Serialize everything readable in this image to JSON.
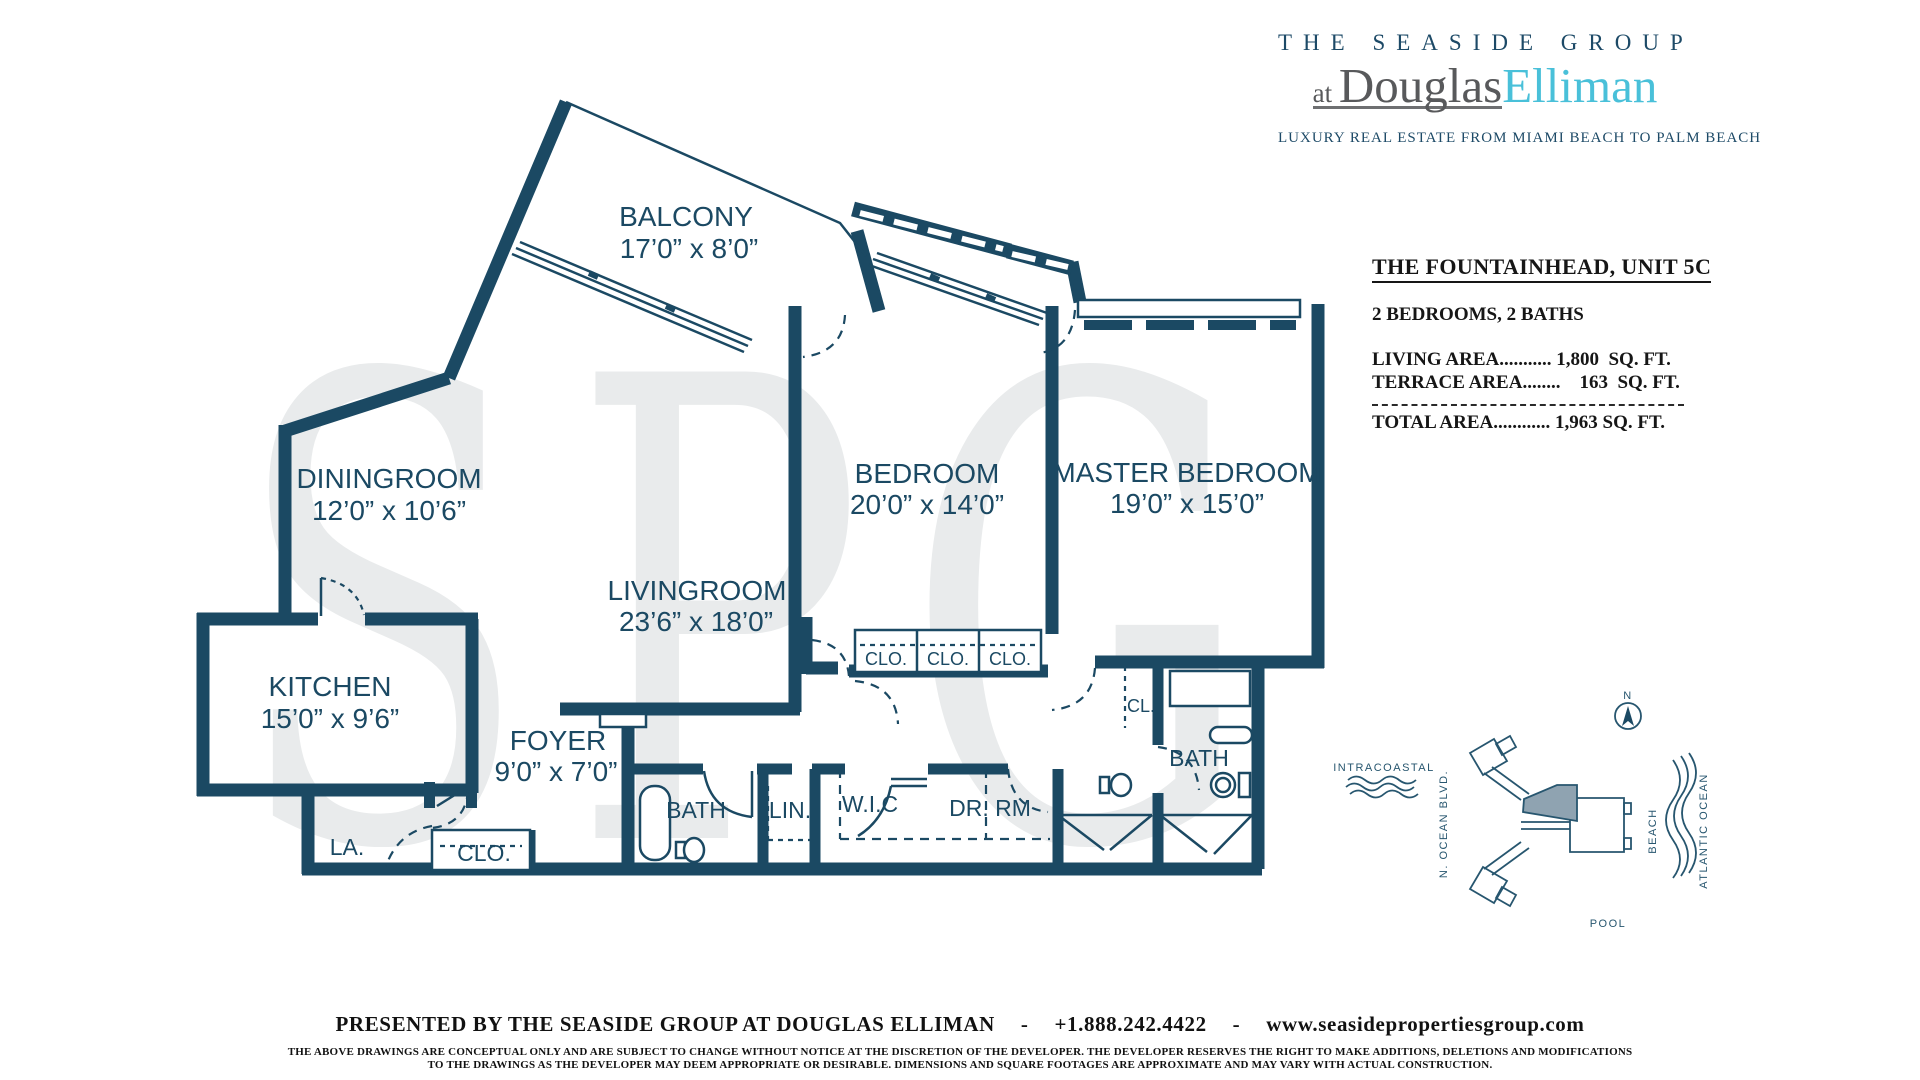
{
  "colors": {
    "wall_navy": "#1b4963",
    "elliman_teal": "#49c0d9",
    "logo_gray": "#58595b",
    "watermark_gray": "#e9ebec",
    "unit_highlight": "#8fa3b1"
  },
  "logo": {
    "line1": "THE SEASIDE GROUP",
    "at": "at ",
    "douglas": "Douglas",
    "elliman": "Elliman",
    "tagline": "LUXURY REAL ESTATE FROM MIAMI BEACH TO PALM BEACH"
  },
  "unit_info": {
    "title": "THE FOUNTAINHEAD, UNIT 5C",
    "subtitle": "2 BEDROOMS, 2 BATHS",
    "living_line": "LIVING AREA........... 1,800  SQ. FT.",
    "terrace_line": "TERRACE AREA........    163  SQ. FT.",
    "total_line": "TOTAL AREA............ 1,963 SQ. FT."
  },
  "watermark": "SPG",
  "plan": {
    "rooms": [
      {
        "name": "BALCONY",
        "dims": "17’0” x 8’0”"
      },
      {
        "name": "DININGROOM",
        "dims": "12’0” x 10’6”"
      },
      {
        "name": "KITCHEN",
        "dims": "15’0” x 9’6”"
      },
      {
        "name": "LIVINGROOM",
        "dims": "23’6” x 18’0”"
      },
      {
        "name": "BEDROOM",
        "dims": "20’0” x 14’0”"
      },
      {
        "name": "MASTER BEDROOM",
        "dims": "19’0” x 15’0”"
      },
      {
        "name": "FOYER",
        "dims": "9’0” x 7’0”"
      }
    ],
    "labels": {
      "la": "LA.",
      "clo_foyer": "CLO.",
      "bath1": "BATH",
      "lin": "LIN.",
      "wic": "W.I.C",
      "dr_rm": "DR. RM",
      "clo1": "CLO.",
      "clo2": "CLO.",
      "clo3": "CLO.",
      "cl": "CL.",
      "bath2": "BATH"
    }
  },
  "site_map": {
    "north": "N",
    "intracoastal": "INTRACOASTAL",
    "n_ocean_blvd": "N. OCEAN BLVD.",
    "beach": "BEACH",
    "atlantic_ocean": "ATLANTIC OCEAN",
    "pool": "POOL"
  },
  "footer": {
    "presented": "PRESENTED BY THE SEASIDE GROUP AT DOUGLAS ELLIMAN",
    "sep": "-",
    "phone": "+1.888.242.4422",
    "sep2": "-",
    "website": "www.seasidepropertiesgroup.com",
    "disclaimer_line1": "THE ABOVE DRAWINGS ARE CONCEPTUAL ONLY AND ARE SUBJECT TO CHANGE WITHOUT NOTICE AT THE DISCRETION OF THE DEVELOPER. THE DEVELOPER RESERVES THE RIGHT TO MAKE ADDITIONS, DELETIONS AND MODIFICATIONS",
    "disclaimer_line2": "TO THE DRAWINGS AS THE DEVELOPER MAY DEEM APPROPRIATE OR DESIRABLE. DIMENSIONS AND SQUARE FOOTAGES ARE APPROXIMATE AND MAY VARY WITH ACTUAL CONSTRUCTION."
  }
}
